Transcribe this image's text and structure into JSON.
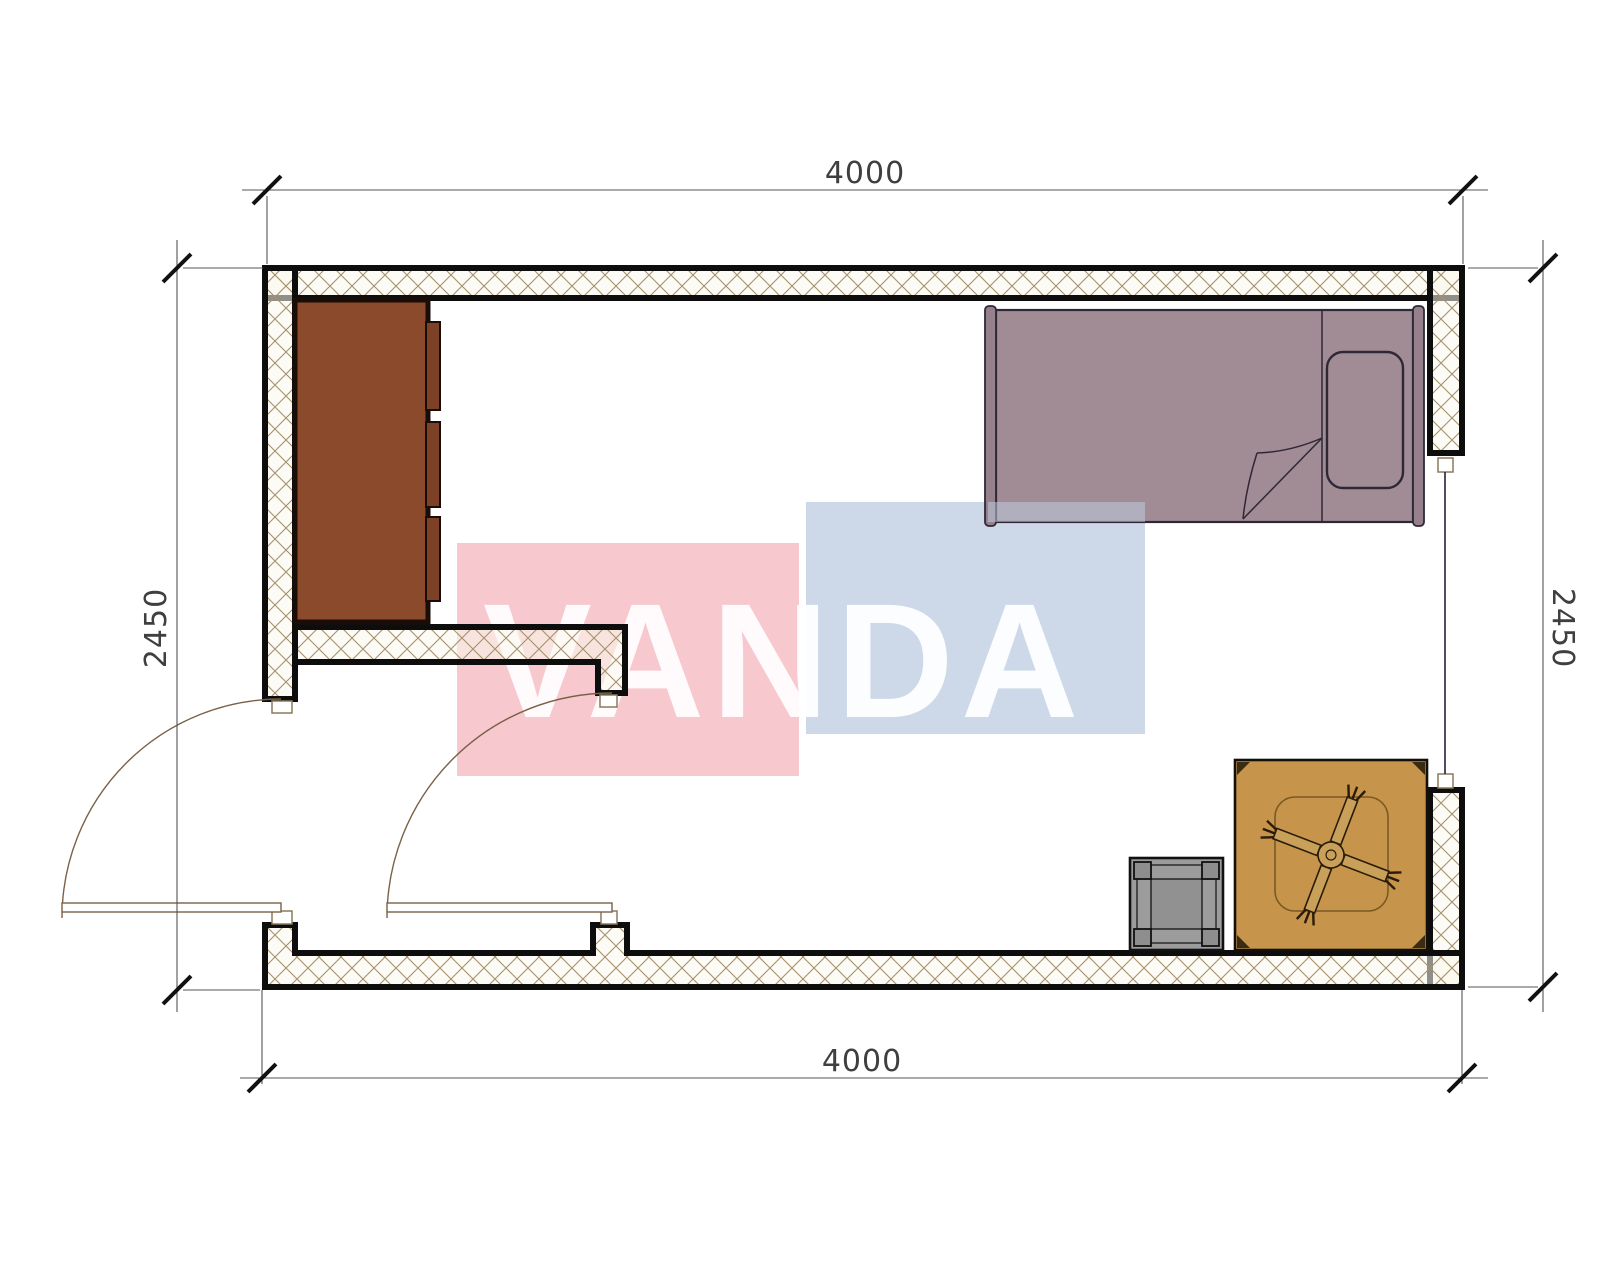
{
  "drawing": {
    "type": "floor-plan",
    "description": "modular room plan with vestibule, wardrobe, bed, table with ceiling fan and stool"
  },
  "dimensions": {
    "top": "4000",
    "bottom": "4000",
    "left": "2450",
    "right": "2450"
  },
  "watermark": {
    "text": "VANDA"
  },
  "colors": {
    "watermark_red": "#f7c9cf",
    "watermark_blue": "#cdd9e9",
    "wall_line": "#0d0d0d",
    "hatch_line": "#a5916b",
    "cabinet": "#8b4a2c",
    "cabinet_dark": "#7c4126",
    "bed": "#a18b95",
    "bed_bar": "#96808c",
    "bed_line": "#2e2836",
    "table": "#c6944a",
    "table_arm": "#c9a05a",
    "stool": "#9c9c9c",
    "stool_post": "#8e8e8e",
    "stool_center": "#919191",
    "dim_text": "#3f3f3f",
    "door_line": "#7a6148"
  },
  "symbols": {
    "wardrobe": "wardrobe-cabinet",
    "bed": "single-bed",
    "pillow": "pillow",
    "blanket_fold": "blanket-fold",
    "table": "square-table",
    "fan": "ceiling-fan",
    "stool": "stool",
    "door_left": "exterior-door-swing",
    "door_inner": "vestibule-door-swing",
    "window": "window-opening"
  }
}
